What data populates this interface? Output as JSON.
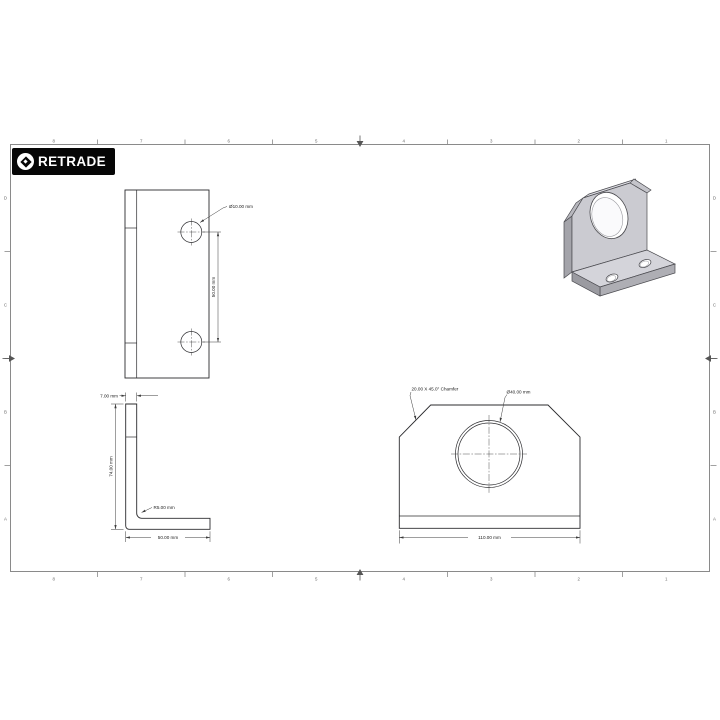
{
  "logo": {
    "brand": "RETRADE",
    "icon": "diamond-pin-icon"
  },
  "frame": {
    "columns_top": [
      "8",
      "7",
      "6",
      "5",
      "4",
      "3",
      "2",
      "1"
    ],
    "columns_bottom": [
      "8",
      "7",
      "6",
      "5",
      "4",
      "3",
      "2",
      "1"
    ],
    "rows_left": [
      "D",
      "C",
      "B",
      "A"
    ],
    "rows_right": [
      "D",
      "C",
      "B",
      "A"
    ]
  },
  "drawing": {
    "top_view": {
      "hole_diameter": "Ø10.00 mm",
      "hole_spacing": "50.00 mm"
    },
    "side_view": {
      "thickness": "7.00 mm",
      "height": "74.00 mm",
      "fillet_radius": "R5.00 mm",
      "flange_length": "50.00 mm"
    },
    "front_view": {
      "chamfer": "20.00 X 45.0° Chamfer",
      "bore_diameter": "Ø40.00 mm",
      "overall_width": "110.00 mm"
    },
    "colors": {
      "part_line": "#2b2b2e",
      "dimension_line": "#3c3c3c",
      "frame_line": "#8a8a8a",
      "iso_face_light": "#cbcbd1",
      "iso_face_mid": "#b2b2b8",
      "iso_face_dark": "#9b9ba1",
      "logo_bg": "#060606"
    }
  }
}
